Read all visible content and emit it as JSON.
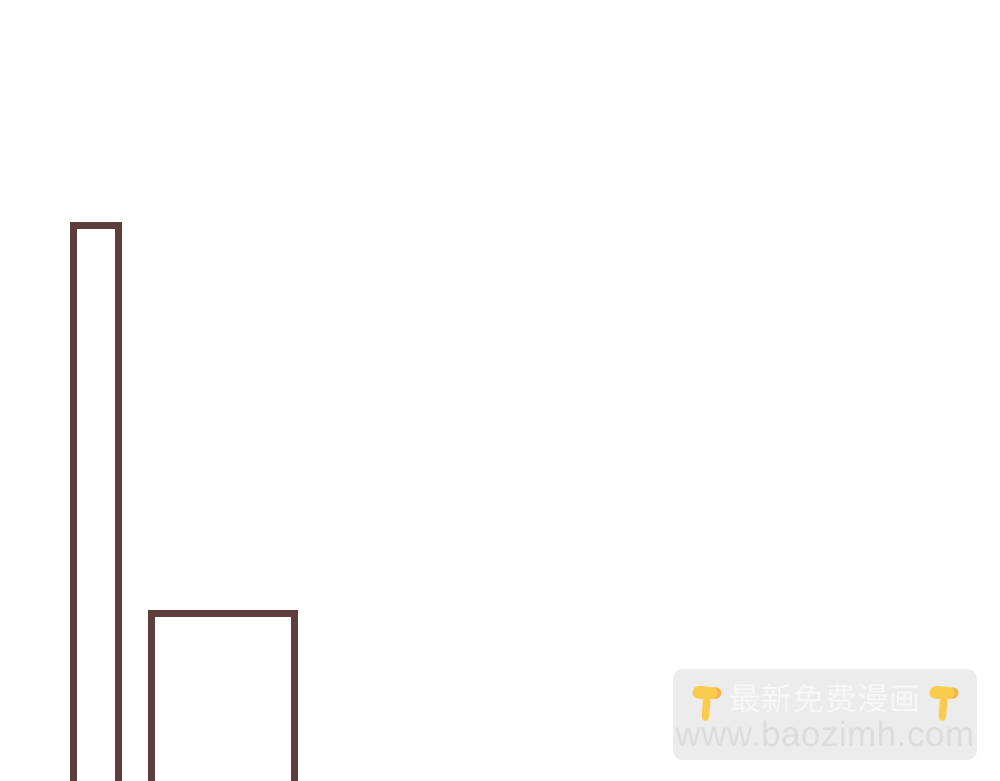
{
  "page": {
    "background_color": "#ffffff",
    "type": "comic-page-segment"
  },
  "artwork": {
    "description": "two unfilled rectangular panel outlines cropped by bottom edge",
    "stroke_color": "#5E3E3C",
    "shapes": [
      {
        "name": "tall-narrow-rectangle-outline",
        "cut_off_bottom": true
      },
      {
        "name": "wide-rectangle-outline",
        "cut_off_bottom": true
      }
    ]
  },
  "watermark": {
    "background_color": "#ECECEC",
    "title_text": "最新免费漫画",
    "title_color": "#F7F7F7",
    "url_text": "www.baozimh.com",
    "url_color": "#DCDCDC",
    "emoji_name": "backhand-index-pointing-down",
    "emoji_color": "#FBCB4E"
  }
}
